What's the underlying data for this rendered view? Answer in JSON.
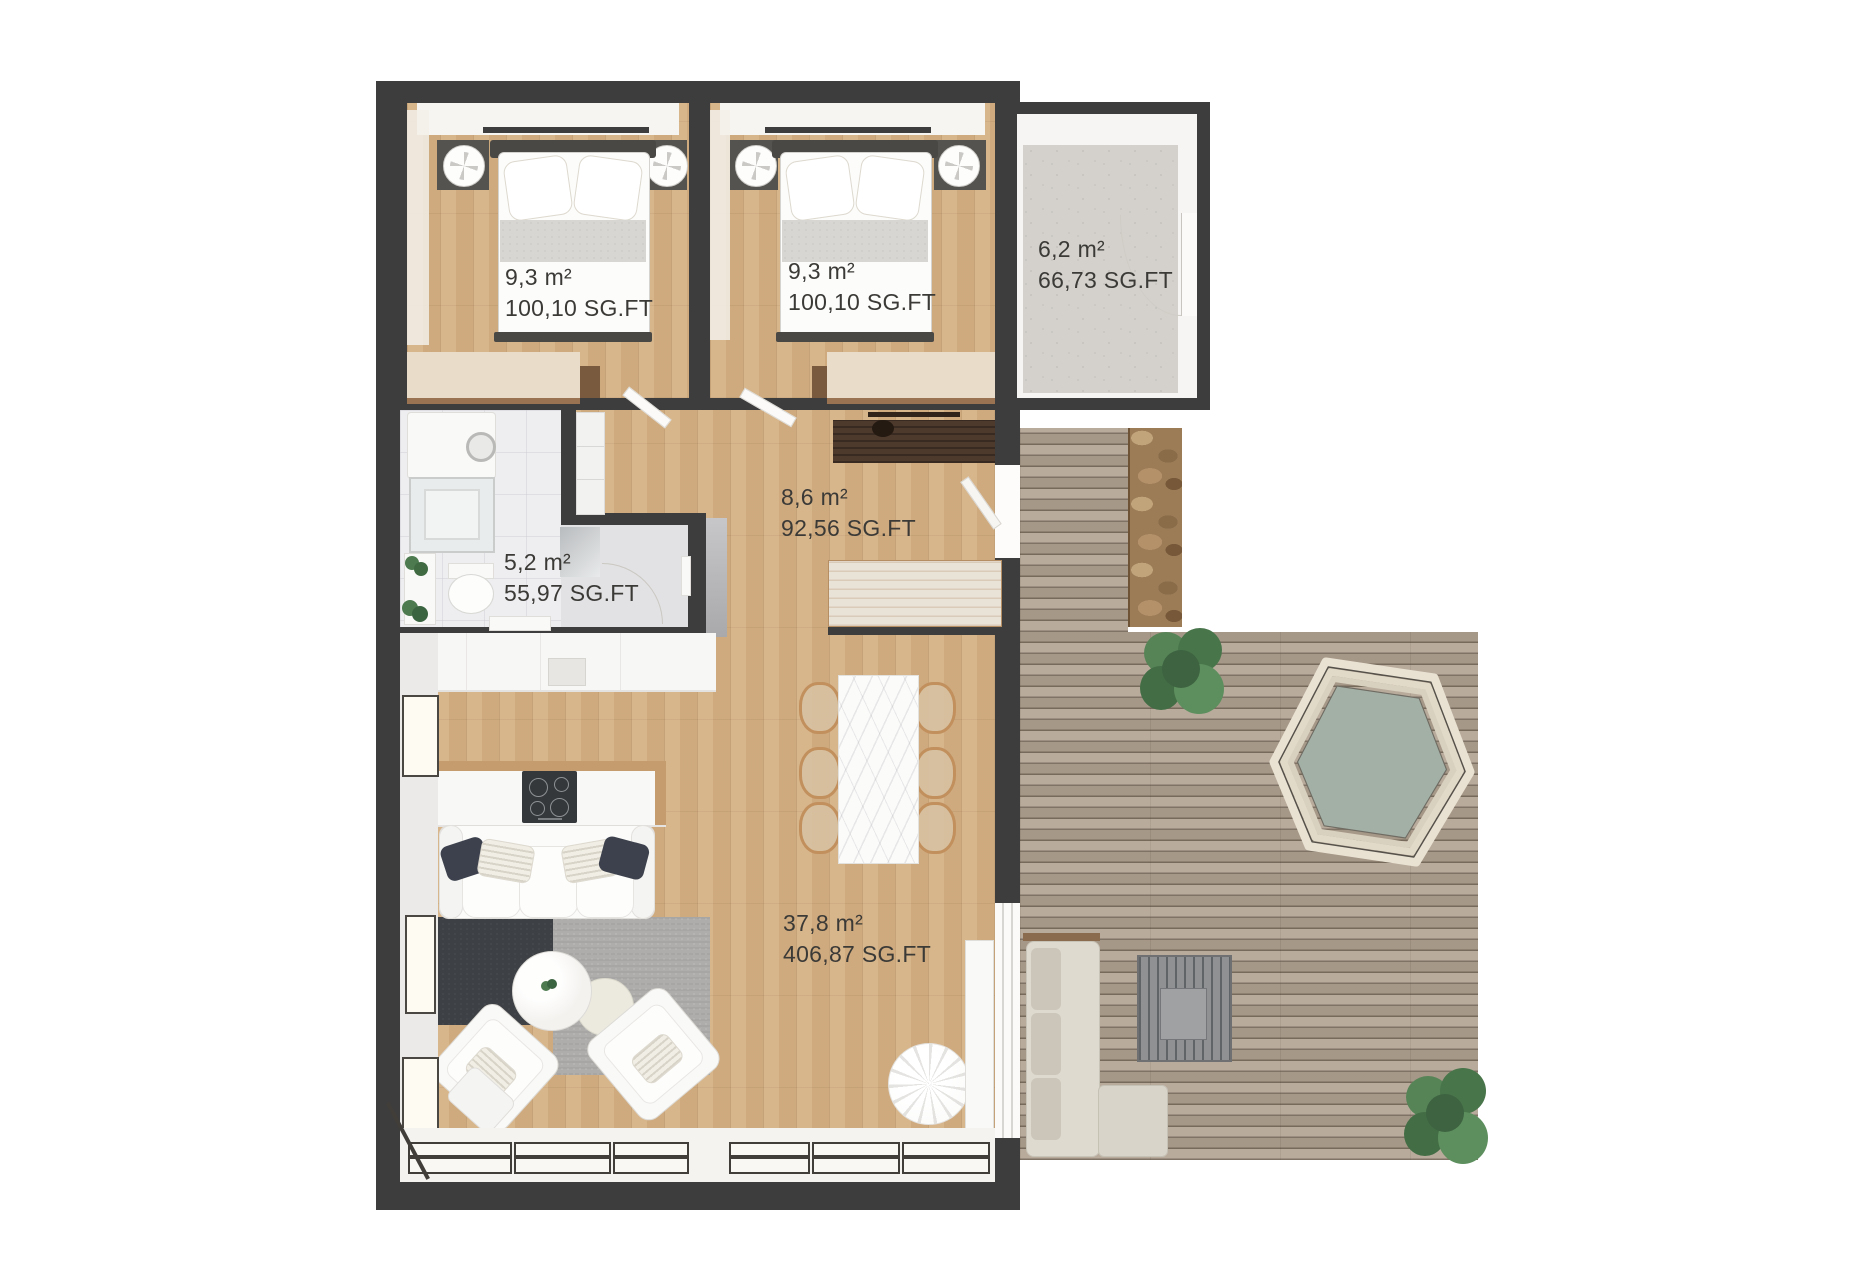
{
  "plan": {
    "rooms": [
      {
        "id": "bedroom-1",
        "area_metric": "9,3 m²",
        "area_imperial": "100,10 SG.FT"
      },
      {
        "id": "bedroom-2",
        "area_metric": "9,3 m²",
        "area_imperial": "100,10 SG.FT"
      },
      {
        "id": "entry-storage",
        "area_metric": "6,2 m²",
        "area_imperial": "66,73 SG.FT"
      },
      {
        "id": "bathroom",
        "area_metric": "5,2 m²",
        "area_imperial": "55,97 SG.FT"
      },
      {
        "id": "hallway",
        "area_metric": "8,6 m²",
        "area_imperial": "92,56 SG.FT"
      },
      {
        "id": "living-kitchen",
        "area_metric": "37,8 m²",
        "area_imperial": "406,87 SG.FT"
      }
    ],
    "colors": {
      "wall": "#3e3d3d",
      "interior_wood": "#d6b185",
      "deck_wood": "#b1a291",
      "concrete_floor": "#d4d1cc",
      "label_text": "#3b3a37",
      "hot_tub_water": "#a3b0a6",
      "rug_dark": "#3d4044",
      "rug_light": "#aeadab"
    }
  }
}
